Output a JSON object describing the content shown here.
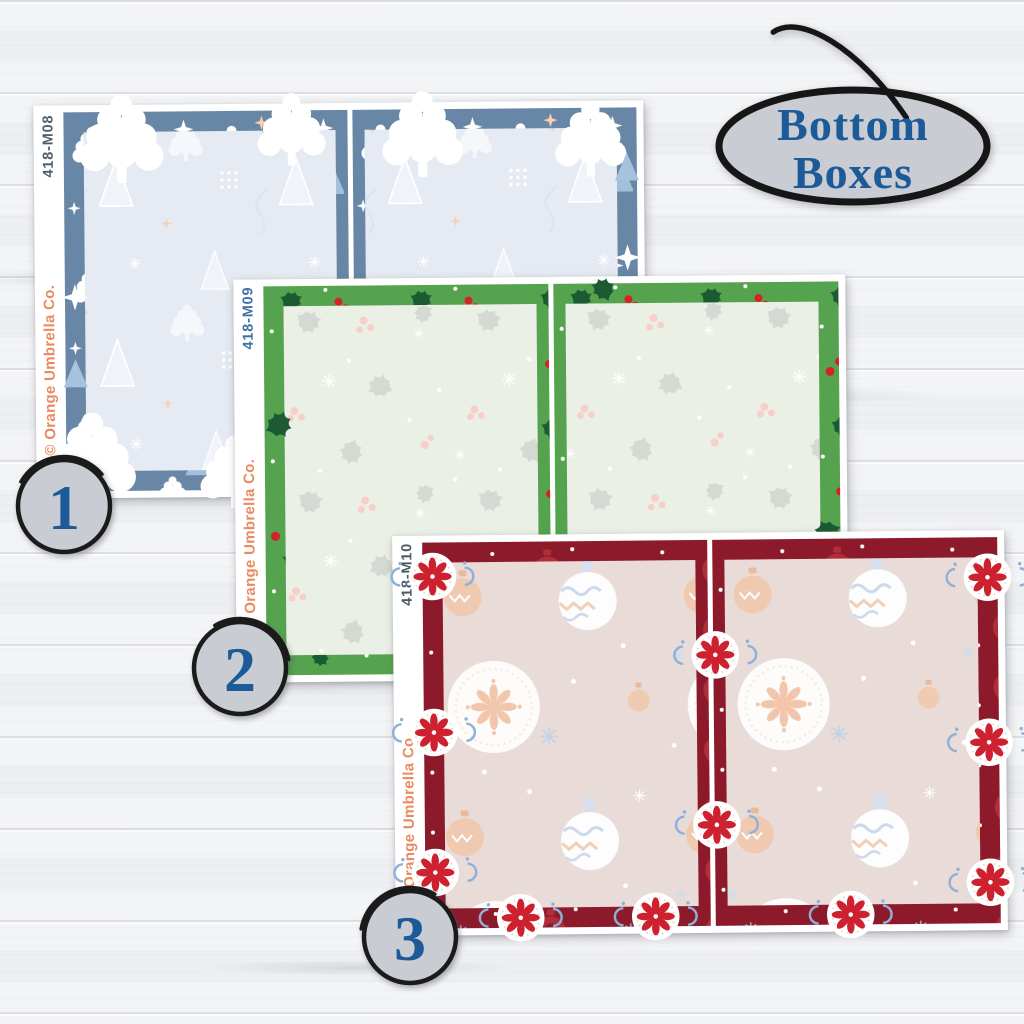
{
  "product_badge": {
    "line1": "Bottom",
    "line2": "Boxes",
    "text_color": "#1d5b98",
    "fill": "#c9ccd2",
    "ring": "#1b1b1b"
  },
  "sheets": [
    {
      "number": "1",
      "code": "418-M08",
      "brand": "© Orange Umbrella Co.",
      "pattern": "winter trees",
      "border_color": "#6886a5",
      "interior_color": "#e6eaf2",
      "code_color": "#4e5e6c",
      "brand_color": "#e98a61"
    },
    {
      "number": "2",
      "code": "418-M09",
      "brand": "© Orange Umbrella Co.",
      "pattern": "holly and berries",
      "border_color": "#55a34e",
      "interior_color": "#ebf0e6",
      "code_color": "#3c72a6",
      "brand_color": "#e98a61"
    },
    {
      "number": "3",
      "code": "418-M10",
      "brand": "© Orange Umbrella Co.",
      "pattern": "christmas ornaments",
      "border_color": "#8c1a2b",
      "interior_color": "#e9dcd8",
      "code_color": "#4b5865",
      "brand_color": "#e98a61"
    }
  ],
  "badge_style": {
    "fill": "#c9ccd2",
    "ring": "#1b1b1b",
    "number_color": "#1d5b98"
  },
  "background": {
    "surface": "white wood planks",
    "base_color": "#f3f4f6"
  }
}
